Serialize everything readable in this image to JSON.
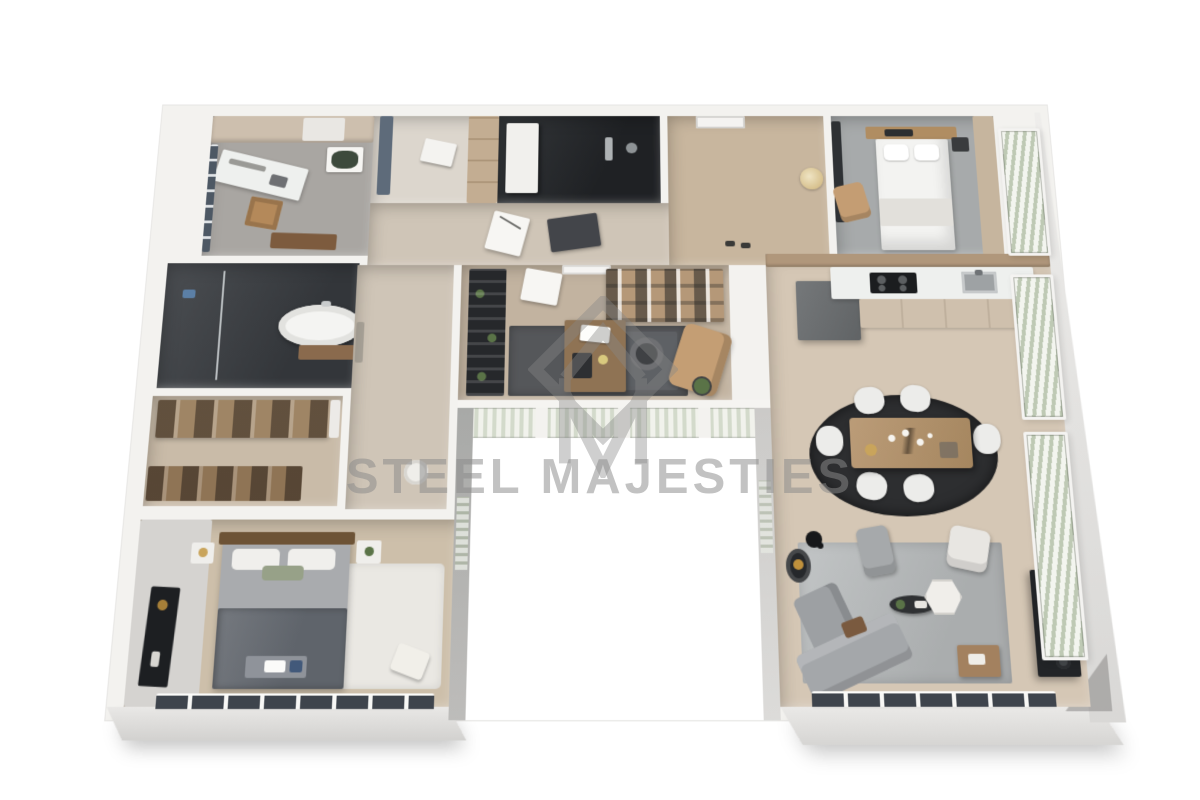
{
  "watermark": {
    "text": "STEEL MAJESTIES",
    "logo": "diamond-M-monogram"
  },
  "scene": {
    "type": "3d-floor-plan-render",
    "view": "top-down isometric",
    "background": "#ffffff"
  },
  "palette": {
    "wall_top": "#f3f2ef",
    "wall_face": "#d9d8d5",
    "wood_floor": "#cdbfab",
    "greige_floor": "#cfc5b7",
    "dark_tile": "#3a3d41",
    "gray_floor": "#a7aaab",
    "rug_dark": "#2d2e30",
    "rug_gray": "#b9bcbd",
    "cabinet_beige": "#cfc0ad",
    "counter_white": "#eef0ee",
    "accent_wood": "#b1926e",
    "tv_black": "#222427",
    "watermark_gray": "#8a8a8a",
    "blind_green": "#bec9b4",
    "orange_fruit": "#e0891c"
  },
  "floorplan": {
    "shape": "U-shaped apartment around a white courtyard notch",
    "rooms": [
      {
        "name": "study-utility",
        "floor": "gray concrete",
        "furniture": [
          "wall cabinets",
          "desk",
          "chair",
          "art frame",
          "wood bench",
          "side window"
        ]
      },
      {
        "name": "bathroom",
        "floor": "dark marble",
        "furniture": [
          "freestanding oval tub",
          "wood tub deck",
          "glass shower partition",
          "towel"
        ]
      },
      {
        "name": "walk-in-closet",
        "floor": "light wood",
        "furniture": [
          "open shelving unit north",
          "open shelving unit south"
        ]
      },
      {
        "name": "bedroom-main",
        "floor": "light wood",
        "furniture": [
          "double bed with dark throw",
          "nightstands",
          "tv panel",
          "foot bench with tray",
          "white rug",
          "ottoman",
          "south windows"
        ]
      },
      {
        "name": "hall-wardrobe",
        "floor": "light",
        "furniture": [
          "wardrobe",
          "mirror panel",
          "blue-gray cabinet"
        ]
      },
      {
        "name": "shower-room",
        "floor": "black tile",
        "furniture": [
          "white door",
          "rain shower fixtures"
        ]
      },
      {
        "name": "corridor",
        "floor": "greige wood",
        "furniture": [
          "two art frames",
          "laundry basket"
        ]
      },
      {
        "name": "entry-hall",
        "floor": "wood",
        "furniture": [
          "front door",
          "round gold mirror",
          "shoes"
        ]
      },
      {
        "name": "home-office",
        "floor": "wood",
        "furniture": [
          "black bookshelf with plants",
          "desk with monitor",
          "task chair",
          "tan lounge chair",
          "niche shelf unit",
          "charcoal rug",
          "potted plant",
          "balcony windows to courtyard"
        ]
      },
      {
        "name": "bedroom-guest",
        "floor": "gray",
        "furniture": [
          "white bed",
          "wood headboard shelf",
          "tan armchair",
          "dark wardrobe",
          "side table"
        ]
      },
      {
        "name": "kitchen",
        "floor": "wood",
        "furniture": [
          "dark gray island block",
          "white counter with cooktop and sink",
          "beige base cabinets",
          "fruit bowl"
        ]
      },
      {
        "name": "dining",
        "floor": "wood",
        "furniture": [
          "black oval rug",
          "wood table with branch centerpiece",
          "six white chairs"
        ]
      },
      {
        "name": "living",
        "floor": "wood",
        "furniture": [
          "gray rug",
          "L-shaped gray sofa",
          "gray armchair",
          "white armchair",
          "black oval coffee table",
          "hexagon side table",
          "wood side table",
          "black media console with decor",
          "round dark chair",
          "floor lamp",
          "south windows"
        ]
      }
    ],
    "windows": [
      "left wall of study",
      "right facade blinds x3",
      "courtyard curtain windows",
      "south windows bedroom-main",
      "south windows living"
    ]
  }
}
